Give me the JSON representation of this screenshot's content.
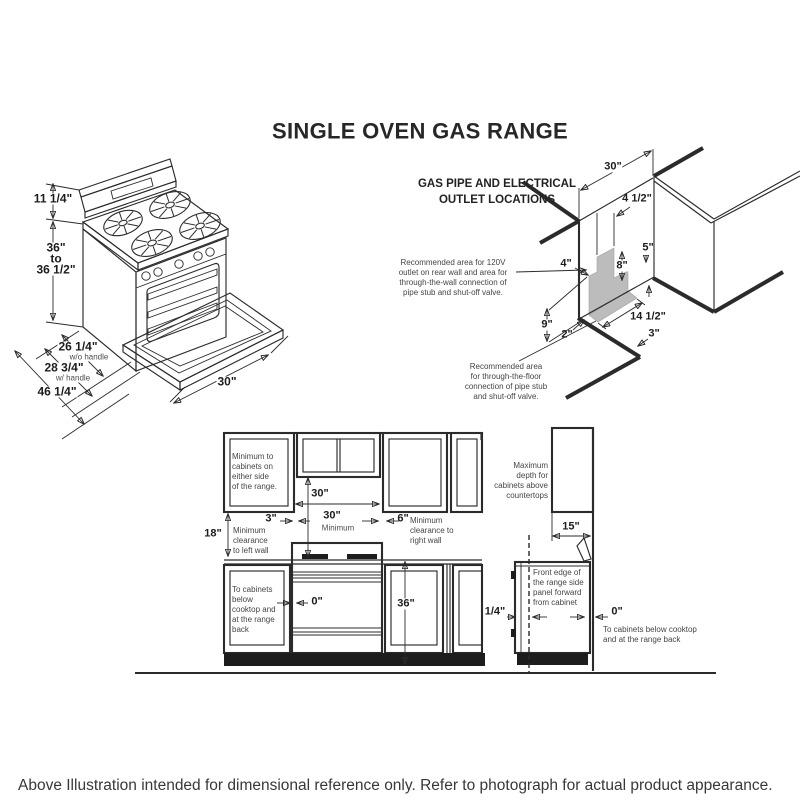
{
  "title": "SINGLE OVEN GAS RANGE",
  "caption": "Above Illustration intended for dimensional reference only. Refer to photograph for actual product appearance.",
  "iso": {
    "dim_back_height": "11 1/4\"",
    "dim_height": "36\"\nto\n36 1/2\"",
    "dim_depth": "26 1/4\"",
    "dim_depth_note": "w/o handle",
    "dim_depth_handle": "28 3/4\"",
    "dim_depth_handle_note": "w/ handle",
    "dim_depth_door": "46 1/4\"",
    "dim_width": "30\""
  },
  "gas": {
    "heading": "GAS PIPE AND ELECTRICAL\nOUTLET LOCATIONS",
    "note_wall": "Recommended area for 120V\noutlet on rear wall and area for\nthrough-the-wall connection of\npipe stub and shut-off valve.",
    "note_floor": "Recommended area\nfor through-the-floor\nconnection of pipe stub\nand shut-off valve.",
    "dims": {
      "d30": "30\"",
      "d45": "4 1/2\"",
      "d5": "5\"",
      "d4": "4\"",
      "d8": "8\"",
      "d9": "9\"",
      "d2": "2\"",
      "d145": "14 1/2\"",
      "d3": "3\""
    }
  },
  "front": {
    "dims": {
      "w30": "30\"",
      "v30": "30\"",
      "v30min": "Minimum",
      "c3": "3\"",
      "c6": "6\"",
      "c18": "18\"",
      "c0": "0\"",
      "h36": "36\""
    },
    "note_side_cabinets": "Minimum to\ncabinets on\neither side\nof the range.",
    "note_left_wall": "Minimum\nclearance\nto left wall",
    "note_right_wall": "Minimum\nclearance to\nright wall",
    "note_below": "To cabinets\nbelow\ncooktop and\nat the range\nback"
  },
  "side": {
    "dims": {
      "d15": "15\"",
      "dq": "1/4\"",
      "d0": "0\""
    },
    "note_max_depth": "Maximum\ndepth for\ncabinets above\ncountertops",
    "note_front_edge": "Front edge of\nthe range side\npanel forward\nfrom cabinet",
    "note_below": "To cabinets below cooktop\nand at the range back"
  }
}
